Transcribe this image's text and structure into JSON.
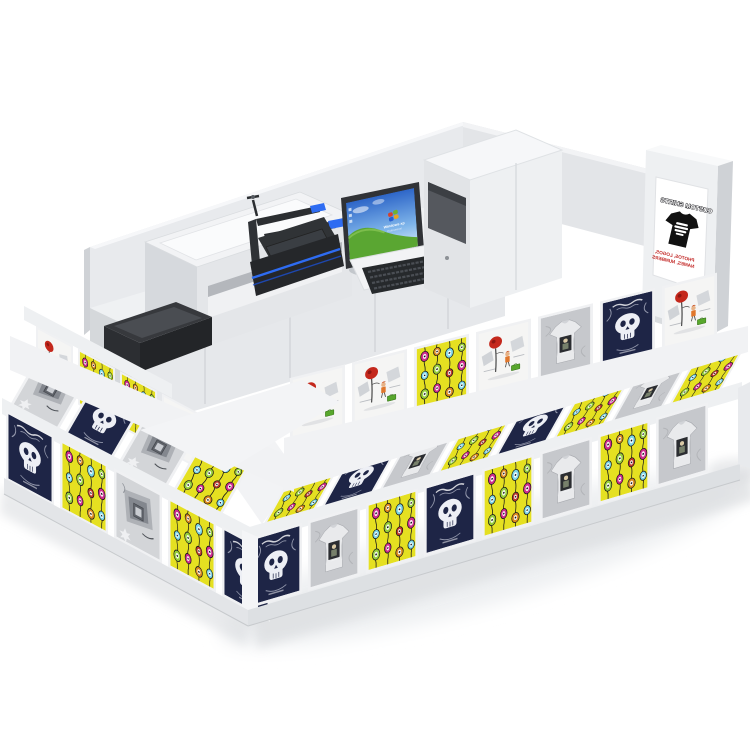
{
  "scene": {
    "description": "3D render of a custom t-shirt printing retail kiosk",
    "background": "#ffffff"
  },
  "palette": {
    "kiosk_white": "#eef0f2",
    "wall_gray": "#e8eaed",
    "shadow_gray": "#d9dbde",
    "device_dark": "#26292c",
    "accent_blue": "#2e6cf2",
    "panel_yellow": "#e5e021",
    "panel_navy": "#1e2546",
    "sign_red": "#c0201e",
    "ornament_pink": "#cf2b8d",
    "ornament_cyan": "#7dd7e8",
    "ornament_green": "#97ce3a",
    "ornament_orange": "#dc8a1f",
    "grass_green": "#5aa632",
    "sky_blue": "#2e66c8"
  },
  "signage": {
    "title": "CUSTOM SHIRTS",
    "line1": "PHOTOS, LOGOS,",
    "line2": "NAMES, NUMBERS"
  },
  "monitor": {
    "brand_line1": "Windows xp",
    "brand_line2": "Professional"
  },
  "equipment": {
    "items": [
      "flatbed-printer",
      "countertop-device",
      "heat-press",
      "monitor",
      "keyboard",
      "storage-hutch",
      "sign-tower"
    ]
  },
  "panels": {
    "left_face": {
      "band1": [
        "tree",
        "yellow",
        "yellow",
        "tree"
      ],
      "band2": [
        "sketch",
        "navy",
        "sketch",
        "yellow"
      ],
      "band3": [
        "navy",
        "yellow",
        "sketch",
        "yellow",
        "navy"
      ]
    },
    "right_face": {
      "band1": [
        "tree",
        "tree",
        "yellow",
        "tree",
        "tshirt",
        "navy",
        "tree"
      ],
      "band2": [
        "yellow",
        "navy",
        "tshirt",
        "yellow",
        "navy",
        "yellow",
        "tshirt",
        "yellow"
      ],
      "band3": [
        "navy",
        "tshirt",
        "yellow",
        "navy",
        "yellow",
        "tshirt",
        "yellow",
        "tshirt"
      ]
    }
  }
}
